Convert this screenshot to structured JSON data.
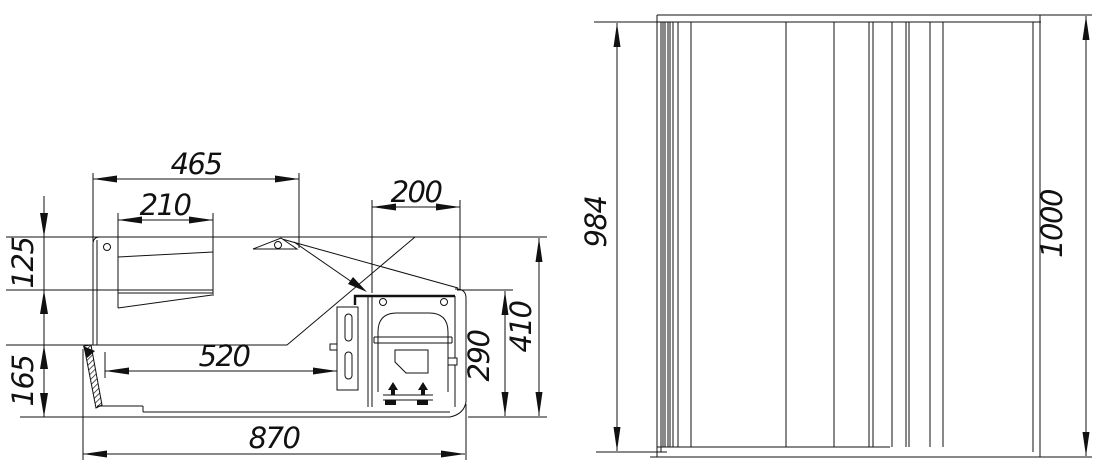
{
  "views": {
    "side_section": {
      "dimensions": {
        "top_width": "465",
        "canopy_width": "210",
        "machine_top_width": "200",
        "canopy_front_height": "125",
        "base_front_height": "165",
        "well_depth": "520",
        "overall_depth": "870",
        "machine_compartment_height": "290",
        "body_height": "410"
      }
    },
    "front": {
      "dimensions": {
        "frame_height": "984",
        "overall_height": "1000"
      }
    }
  }
}
